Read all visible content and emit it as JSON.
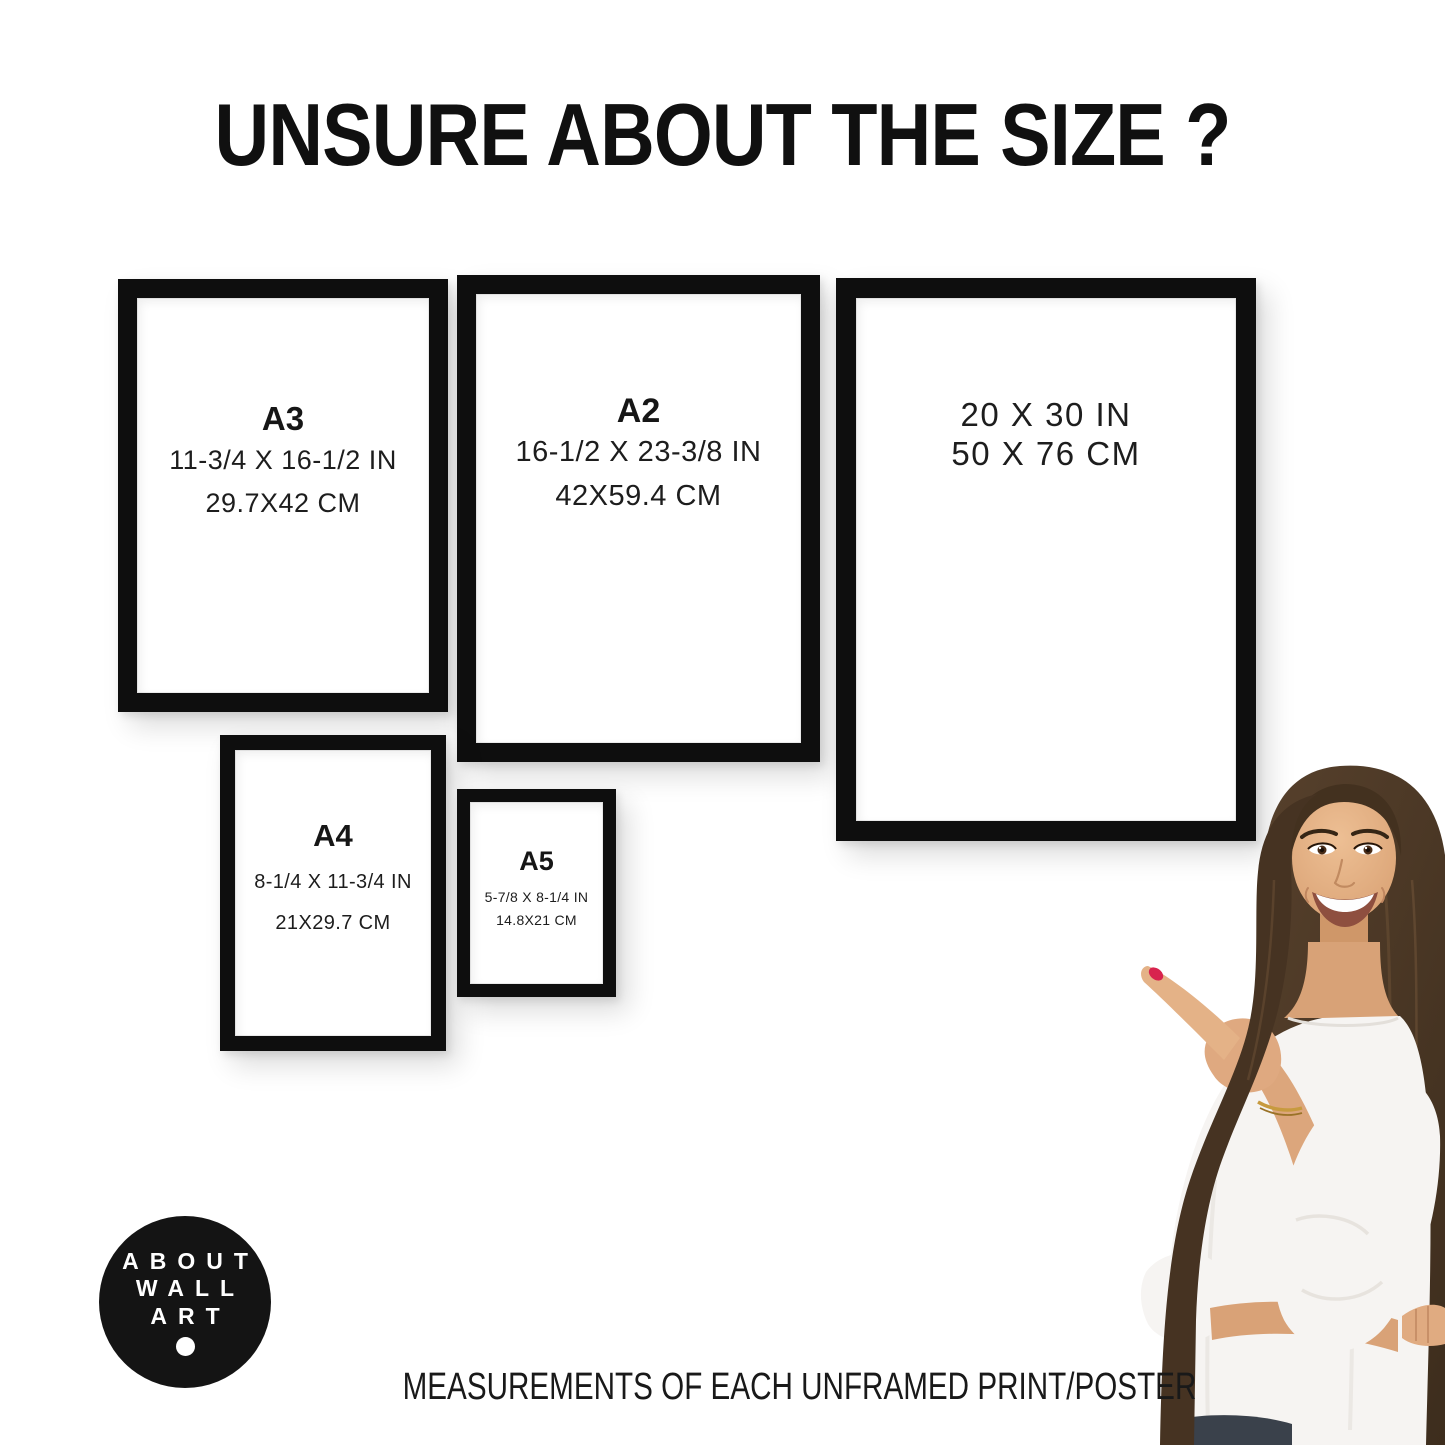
{
  "title": "UNSURE ABOUT THE SIZE ?",
  "frames": [
    {
      "name": "A3",
      "size_in": "11-3/4 X 16-1/2 IN",
      "size_cm": "29.7X42 CM"
    },
    {
      "name": "A2",
      "size_in": "16-1/2 X 23-3/8 IN",
      "size_cm": "42X59.4 CM"
    },
    {
      "name": "",
      "size_in": "20 X 30 IN",
      "size_cm": "50 X 76 CM"
    },
    {
      "name": "A4",
      "size_in": "8-1/4 X 11-3/4 IN",
      "size_cm": "21X29.7 CM"
    },
    {
      "name": "A5",
      "size_in": "5-7/8 X 8-1/4 IN",
      "size_cm": "14.8X21 CM"
    }
  ],
  "logo": {
    "lines": [
      "ABOUT",
      "WALL",
      "ART"
    ]
  },
  "caption": "MEASUREMENTS OF EACH UNFRAMED PRINT/POSTER",
  "colors": {
    "background": "#ffffff",
    "frame_border": "#0e0e0e",
    "text": "#1b1b1b",
    "logo_bg": "#141414",
    "logo_text": "#ffffff",
    "nail_polish": "#d8234e",
    "hair": "#4c3826",
    "skin": "#dfa980",
    "blouse": "#f6f4f2",
    "jeans": "#3a414b",
    "bracelet": "#c79a3f"
  }
}
